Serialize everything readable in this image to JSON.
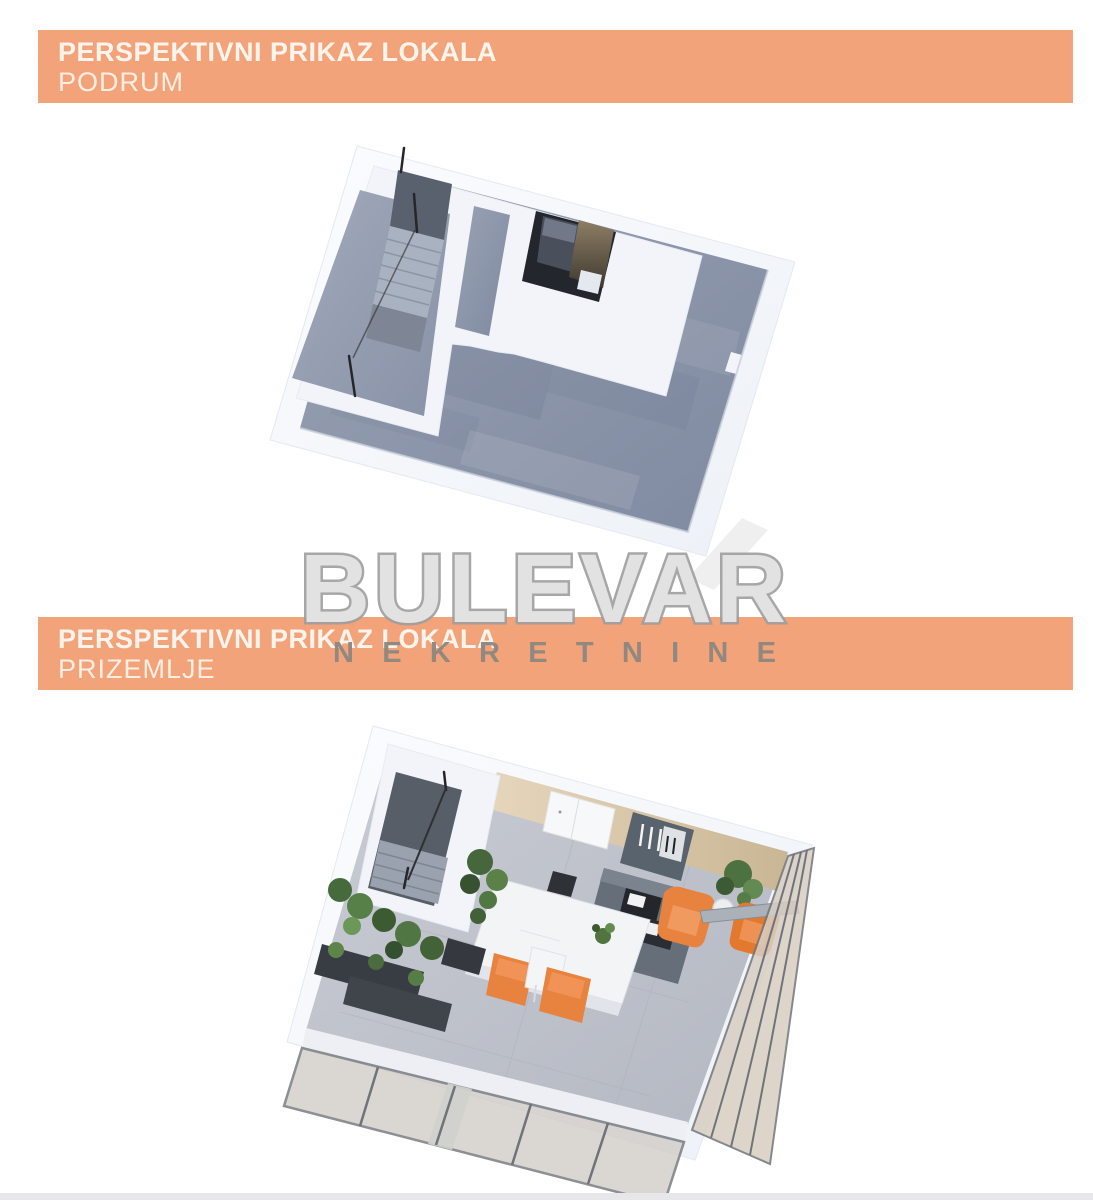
{
  "window": {
    "width": 1093,
    "height": 1200,
    "background": "#ffffff"
  },
  "headers": {
    "basement": {
      "title": "PERSPEKTIVNI PRIKAZ LOKALA",
      "subtitle": "PODRUM"
    },
    "ground_floor": {
      "title": "PERSPEKTIVNI PRIKAZ LOKALA",
      "subtitle": "PRIZEMLJE"
    }
  },
  "watermark": {
    "brand": "BULEVAR",
    "tagline": "NEKRETNINE"
  },
  "figures": {
    "basement": {
      "content": "3d-perspective-floorplan-basement"
    },
    "ground_floor": {
      "content": "3d-perspective-floorplan-ground-floor"
    }
  },
  "colors": {
    "banner_orange": "#F3A379",
    "banner_text": "#FDF5ED",
    "watermark_fill": "#E2E2E2",
    "watermark_outline": "#9E9E9E",
    "watermark_tagline": "#8C8780",
    "basement_floor": "#8D97A9",
    "ground_floor": "#C3C6CE",
    "wall_white": "#F3F5F9",
    "wood_wall": "#DCCBB0",
    "stair_dark": "#5A6270",
    "furniture_orange": "#E8823F",
    "plant_green": "#4F7243",
    "glass_frame": "#70747A",
    "footer_strip": "#E7E7E9"
  }
}
